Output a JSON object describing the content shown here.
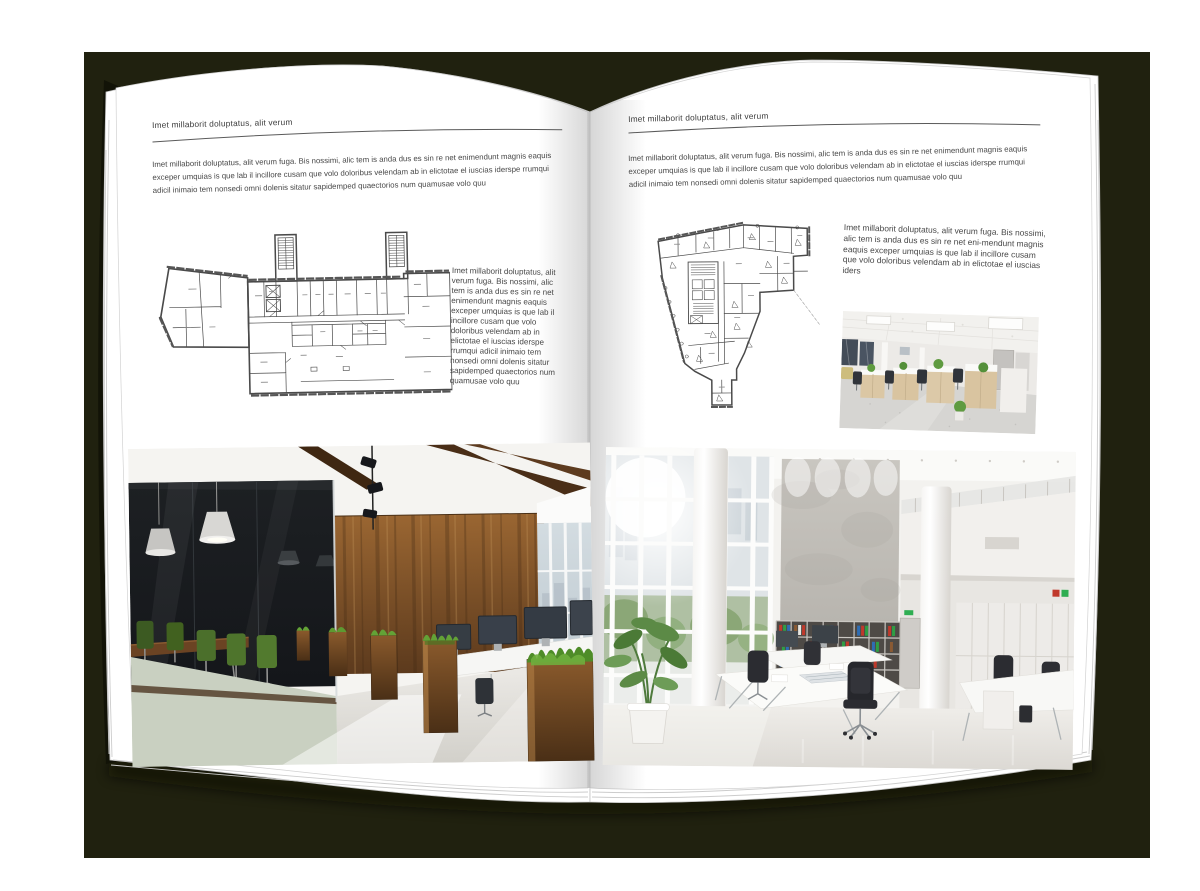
{
  "book": {
    "left_page": {
      "header": "Imet millaborit doluptatus, alit verum",
      "intro": "Imet millaborit doluptatus, alit verum fuga. Bis nossimi, alic tem is anda dus es sin re net enimendunt magnis eaquis exceper umquias is que lab il incillore cusam que volo doloribus velendam ab in elictotae el iuscias iderspe rrumqui adicil inimaio tem nonsedi omni dolenis sitatur sapidemped quaectorios num quamusae volo quu",
      "caption": "Imet millaborit doluptatus, alit verum fuga. Bis nossimi, alic tem is anda dus es sin re net enimendunt magnis eaquis exceper umquias is que lab il incillore cusam que volo doloribus velendam ab in elictotae el iuscias iderspe rrumqui adicil inimaio tem nonsedi omni dolenis sitatur sapidemped quaectorios num quamusae volo quu",
      "floor_plan_name": "two-stair-tower-office-floor-plan",
      "photo_name": "dark-loft-office-with-glass-meeting-room"
    },
    "right_page": {
      "header": "Imet millaborit doluptatus, alit verum",
      "intro": "Imet millaborit doluptatus, alit verum fuga. Bis nossimi, alic tem is anda dus es sin re net enimendunt magnis eaquis exceper umquias is que lab il incillore cusam que volo doloribus velendam ab in elictotae el iuscias iderspe rrumqui adicil inimaio tem nonsedi omni dolenis sitatur sapidemped quaectorios num quamusae volo quu",
      "caption": "Imet millaborit doluptatus, alit verum fuga. Bis nossimi, alic tem is anda dus es sin re net eni-mendunt magnis eaquis exceper umquias is que lab il incillore cusam que volo doloribus velendam ab in elictotae el iuscias iders",
      "floor_plan_name": "irregular-corner-building-floor-plan",
      "photo_small_name": "bright-open-plan-office-workstations",
      "photo_large_name": "white-double-height-office-atrium"
    }
  },
  "colors": {
    "backdrop": "#20210f",
    "page": "#ffffff",
    "ink": "#3f3f3f",
    "plan_line": "#4a4a4a"
  }
}
